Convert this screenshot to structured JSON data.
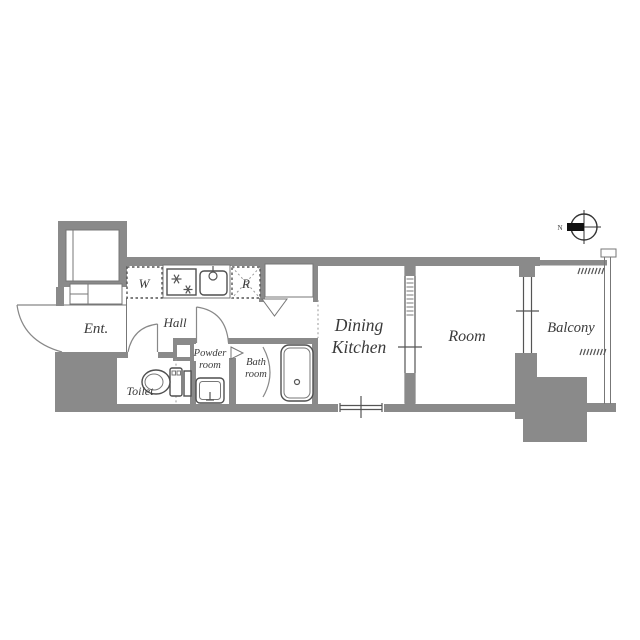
{
  "floorplan": {
    "rooms": {
      "entrance": "Ent.",
      "hall": "Hall",
      "toilet": "Toilet",
      "powder_line1": "Powder",
      "powder_line2": "room",
      "bath_line1": "Bath",
      "bath_line2": "room",
      "dk_line1": "Dining",
      "dk_line2": "Kitchen",
      "room": "Room",
      "balcony": "Balcony"
    },
    "fixtures": {
      "washer": "W",
      "fridge": "R"
    },
    "compass": {
      "north": "N"
    },
    "colors": {
      "wall": "#8a8a8a",
      "line": "#777777",
      "dark_line": "#4f4f4f",
      "text": "#3a3a3a",
      "background": "#ffffff"
    }
  }
}
